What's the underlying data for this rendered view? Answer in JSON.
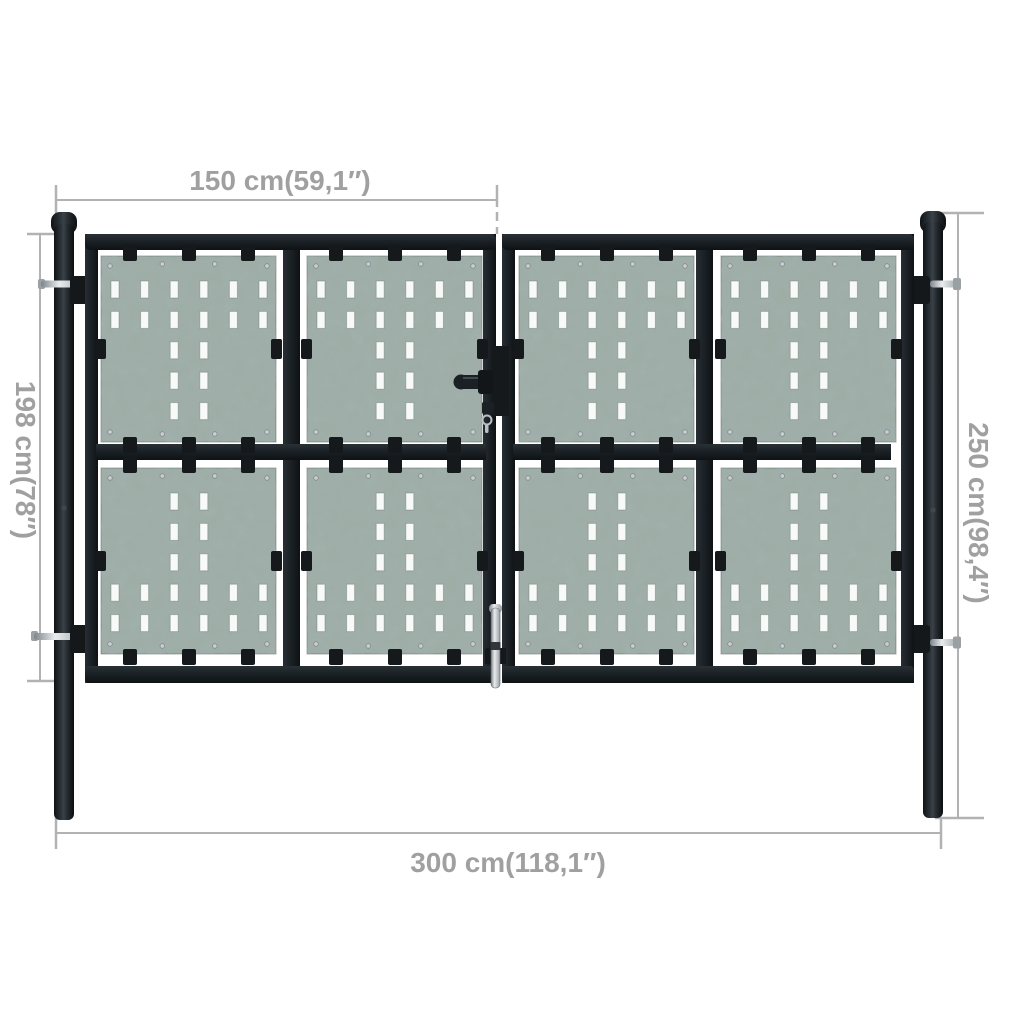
{
  "dimensions": {
    "top": "150 cm(59,1″)",
    "left": "198 cm(78″)",
    "right": "250 cm(98,4″)",
    "bottom": "300 cm(118,1″)"
  },
  "colors": {
    "background": "#ffffff",
    "frame": "#15191c",
    "frame_highlight": "#343b41",
    "panel": "#9fada7",
    "panel_mottle": "#5a706a",
    "slot": "#f8faf9",
    "screw": "#c9cdcf",
    "metal_pin": "#c2c7ca",
    "dimension_line": "#b2b2b2",
    "dimension_text": "#a0a0a0"
  },
  "gate": {
    "posts": 2,
    "leaves": 2,
    "panels_per_leaf": 4,
    "panel_grid": {
      "columns": 6,
      "rows": 5
    },
    "panel_pattern": {
      "top_panel": [
        [
          1,
          1,
          1,
          1,
          1,
          1
        ],
        [
          1,
          1,
          1,
          1,
          1,
          1
        ],
        [
          0,
          0,
          1,
          1,
          0,
          0
        ],
        [
          0,
          0,
          1,
          1,
          0,
          0
        ],
        [
          0,
          0,
          1,
          1,
          0,
          0
        ]
      ],
      "bottom_panel": [
        [
          0,
          0,
          1,
          1,
          0,
          0
        ],
        [
          0,
          0,
          1,
          1,
          0,
          0
        ],
        [
          0,
          0,
          1,
          1,
          0,
          0
        ],
        [
          1,
          1,
          1,
          1,
          1,
          1
        ],
        [
          1,
          1,
          1,
          1,
          1,
          1
        ]
      ]
    }
  }
}
